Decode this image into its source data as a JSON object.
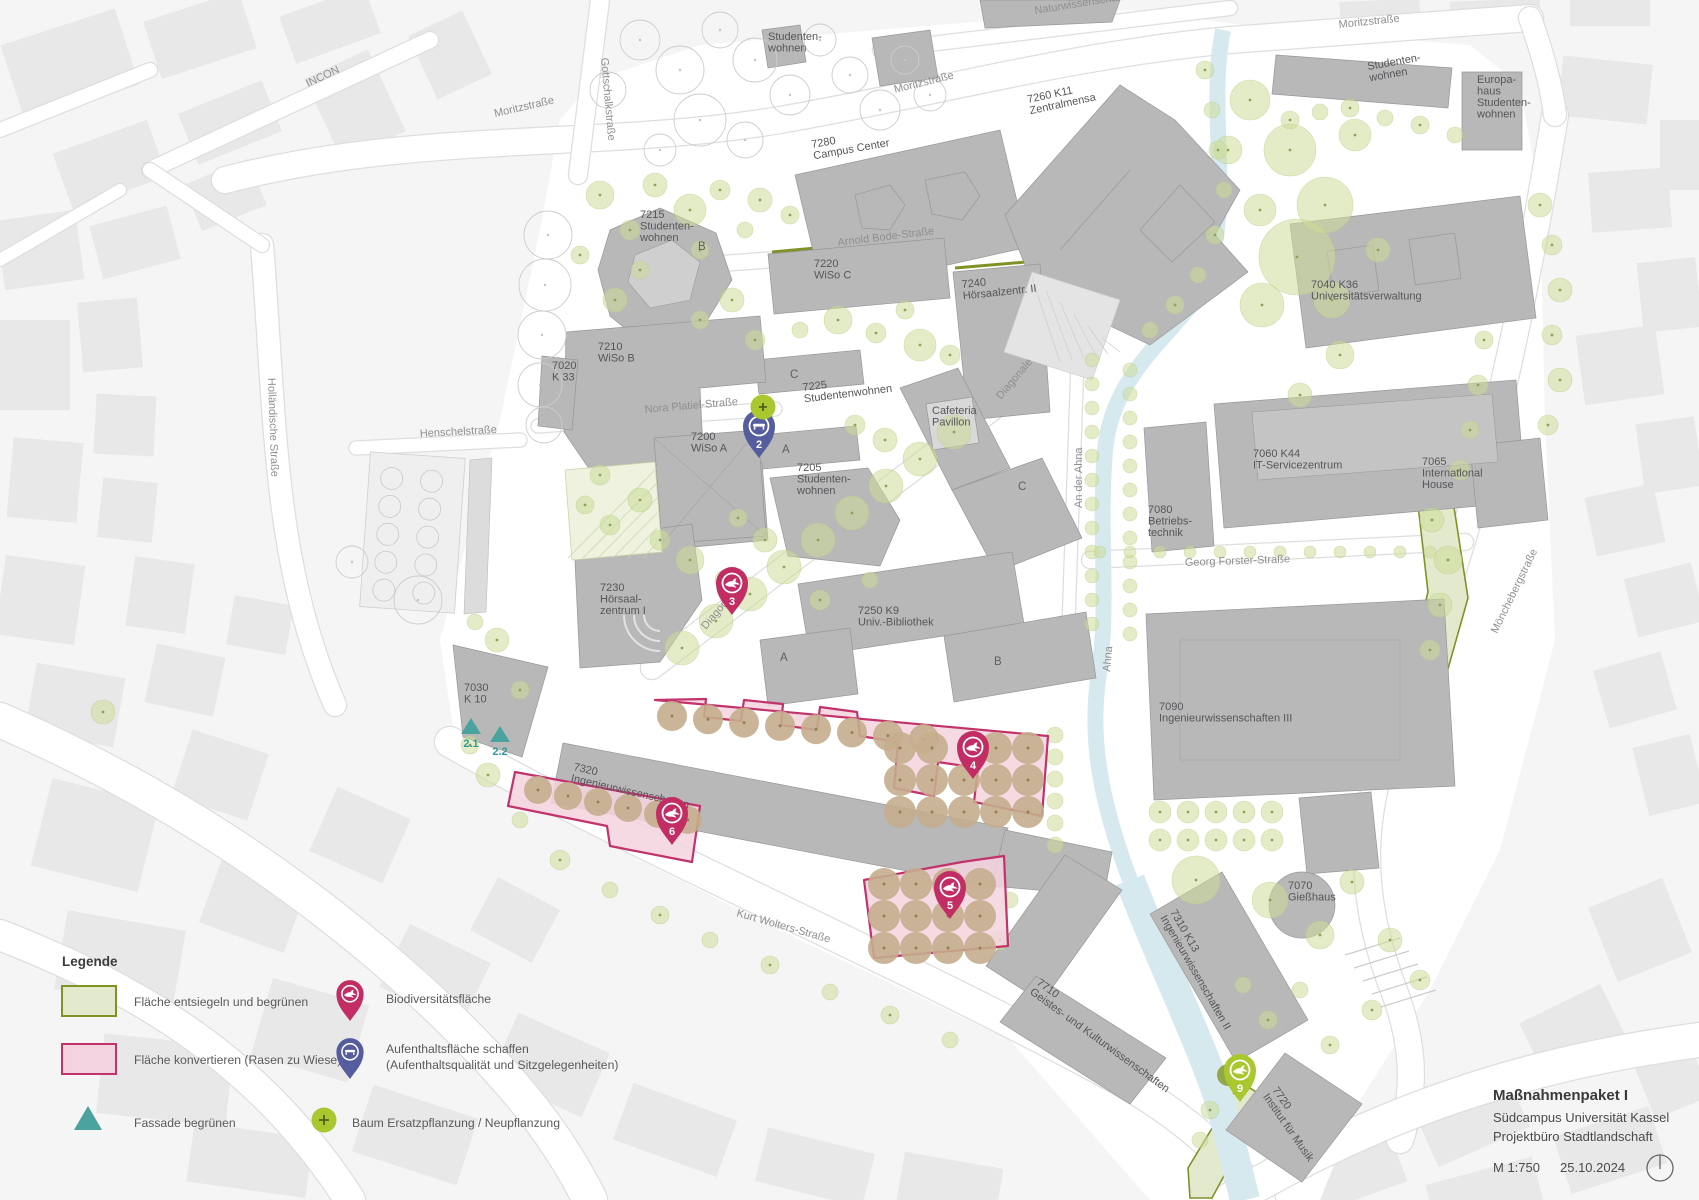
{
  "title_block": {
    "title": "Maßnahmenpaket I",
    "subtitle1": "Südcampus Universität Kassel",
    "subtitle2": "Projektbüro Stadtlandschaft",
    "scale": "M 1:750",
    "date": "25.10.2024"
  },
  "legend": {
    "heading": "Legende",
    "items": [
      {
        "swatch": "area-green",
        "label": "Fläche entsiegeln und begrünen"
      },
      {
        "swatch": "area-pink",
        "label": "Fläche konvertieren (Rasen zu Wiese)"
      },
      {
        "swatch": "pin-pink-bird",
        "label": "Biodiversitätsfläche"
      },
      {
        "swatch": "pin-blue-bench",
        "label": "Aufenthaltsfläche schaffen",
        "label2": "(Aufenthaltsqualität und Sitzgelegenheiten)"
      },
      {
        "swatch": "triangle-teal",
        "label": "Fassade begrünen"
      },
      {
        "swatch": "tree-plus",
        "label": "Baum Ersatzpflanzung / Neupflanzung"
      }
    ]
  },
  "colors": {
    "pin_pink": "#c22e63",
    "pin_blue": "#555d9e",
    "pin_green": "#a9c72f",
    "teal": "#4aa39f",
    "area_green_stroke": "#7f9226",
    "area_green_fill": "#e3e9cd",
    "area_pink_stroke": "#c2326b",
    "area_pink_fill": "#f3d3df",
    "stream": "#d6e9ef",
    "building": "#b8b8b8",
    "tree_green": "#ccdd99",
    "tree_tan": "#c5ad8d"
  },
  "map": {
    "street_labels": [
      {
        "text": "INCON",
        "x": 308,
        "y": 87,
        "rot": -25
      },
      {
        "text": "Moritzstraße",
        "x": 495,
        "y": 117,
        "rot": -13
      },
      {
        "text": "Moritzstraße",
        "x": 895,
        "y": 93,
        "rot": -14
      },
      {
        "text": "Moritzstraße",
        "x": 1339,
        "y": 28,
        "rot": -6
      },
      {
        "text": "Naturwissenschaften",
        "x": 1035,
        "y": 14,
        "rot": -9
      },
      {
        "text": "Gottschalkstraße",
        "x": 601,
        "y": 58,
        "rot": 85
      },
      {
        "text": "Holländische Straße",
        "x": 268,
        "y": 378,
        "rot": 88
      },
      {
        "text": "Henschelstraße",
        "x": 420,
        "y": 437,
        "rot": -3
      },
      {
        "text": "Arnold Bode-Straße",
        "x": 838,
        "y": 246,
        "rot": -7
      },
      {
        "text": "Nora Platiel-Straße",
        "x": 645,
        "y": 413,
        "rot": -5
      },
      {
        "text": "Diagonale",
        "x": 1001,
        "y": 400,
        "rot": -50
      },
      {
        "text": "Diagonale",
        "x": 706,
        "y": 630,
        "rot": -50
      },
      {
        "text": "Kurt Wolters-Straße",
        "x": 736,
        "y": 916,
        "rot": 16
      },
      {
        "text": "Georg Forster-Straße",
        "x": 1185,
        "y": 566,
        "rot": -2
      },
      {
        "text": "An der Ahna",
        "x": 1082,
        "y": 508,
        "rot": -90
      },
      {
        "text": "Ahna",
        "x": 1110,
        "y": 672,
        "rot": -85
      },
      {
        "text": "Mönchebergstraße",
        "x": 1497,
        "y": 634,
        "rot": -64
      }
    ],
    "building_labels": [
      {
        "lines": [
          "Studenten-",
          "wohnen"
        ],
        "x": 768,
        "y": 40
      },
      {
        "lines": [
          "7280",
          "Campus Center"
        ],
        "x": 812,
        "y": 148,
        "rot": -10
      },
      {
        "lines": [
          "7260 K11",
          "Zentralmensa"
        ],
        "x": 1028,
        "y": 103,
        "rot": -12
      },
      {
        "lines": [
          "7215",
          "Studenten-",
          "wohnen"
        ],
        "x": 640,
        "y": 218
      },
      {
        "lines": [
          "B"
        ],
        "x": 698,
        "y": 250
      },
      {
        "lines": [
          "7220",
          "WiSo C"
        ],
        "x": 814,
        "y": 267
      },
      {
        "lines": [
          "7240",
          "Hörsaalzentr. II"
        ],
        "x": 962,
        "y": 288,
        "rot": -6
      },
      {
        "lines": [
          "7210",
          "WiSo B"
        ],
        "x": 598,
        "y": 350
      },
      {
        "lines": [
          "7020",
          "K 33"
        ],
        "x": 552,
        "y": 369
      },
      {
        "lines": [
          "C"
        ],
        "x": 790,
        "y": 378
      },
      {
        "lines": [
          "7225",
          "Studentenwohnen"
        ],
        "x": 803,
        "y": 391,
        "rot": -7
      },
      {
        "lines": [
          "Cafeteria",
          "Pavillon"
        ],
        "x": 932,
        "y": 414
      },
      {
        "lines": [
          "7200",
          "WiSo A"
        ],
        "x": 691,
        "y": 440
      },
      {
        "lines": [
          "A"
        ],
        "x": 782,
        "y": 453
      },
      {
        "lines": [
          "7205",
          "Studenten-",
          "wohnen"
        ],
        "x": 797,
        "y": 471
      },
      {
        "lines": [
          "C"
        ],
        "x": 1018,
        "y": 490
      },
      {
        "lines": [
          "7080",
          "Betriebs-",
          "technik"
        ],
        "x": 1148,
        "y": 513
      },
      {
        "lines": [
          "7060 K44",
          "IT-Servicezentrum"
        ],
        "x": 1253,
        "y": 457
      },
      {
        "lines": [
          "7065",
          "International",
          "House"
        ],
        "x": 1422,
        "y": 465
      },
      {
        "lines": [
          "7040 K36",
          "Universitätsverwaltung"
        ],
        "x": 1311,
        "y": 288
      },
      {
        "lines": [
          "7230",
          "Hörsaal-",
          "zentrum I"
        ],
        "x": 600,
        "y": 591
      },
      {
        "lines": [
          "7250 K9",
          "Univ.-Bibliothek"
        ],
        "x": 858,
        "y": 614
      },
      {
        "lines": [
          "A"
        ],
        "x": 780,
        "y": 661
      },
      {
        "lines": [
          "B"
        ],
        "x": 994,
        "y": 665
      },
      {
        "lines": [
          "7030",
          "K 10"
        ],
        "x": 464,
        "y": 691
      },
      {
        "lines": [
          "7090",
          "Ingenieurwissenschaften III"
        ],
        "x": 1159,
        "y": 710
      },
      {
        "lines": [
          "7320",
          "Ingenieurwissenschaften"
        ],
        "x": 573,
        "y": 770,
        "rot": 13
      },
      {
        "lines": [
          "7310 K13",
          "Ingenieurwissenschaften II"
        ],
        "x": 1170,
        "y": 912,
        "rot": 60
      },
      {
        "lines": [
          "7710",
          "Geistes- und Kulturwissenschaften"
        ],
        "x": 1036,
        "y": 984,
        "rot": 36
      },
      {
        "lines": [
          "7070",
          "Gießhaus"
        ],
        "x": 1288,
        "y": 889
      },
      {
        "lines": [
          "7720",
          "Institut für Musik"
        ],
        "x": 1272,
        "y": 1090,
        "rot": 55
      },
      {
        "lines": [
          "Studenten-",
          "wohnen"
        ],
        "x": 1368,
        "y": 70,
        "rot": -10
      },
      {
        "lines": [
          "Europa-",
          "haus",
          "Studenten-",
          "wohnen"
        ],
        "x": 1477,
        "y": 83
      }
    ],
    "markers": [
      {
        "id": "2",
        "type": "seating",
        "x": 759,
        "y": 431
      },
      {
        "id": "3",
        "type": "biodiversity",
        "x": 732,
        "y": 588
      },
      {
        "id": "4",
        "type": "biodiversity",
        "x": 973,
        "y": 752
      },
      {
        "id": "5",
        "type": "biodiversity",
        "x": 950,
        "y": 892
      },
      {
        "id": "6",
        "type": "biodiversity",
        "x": 672,
        "y": 818
      },
      {
        "id": "9",
        "type": "greening",
        "x": 1240,
        "y": 1075
      }
    ],
    "facade_markers": [
      {
        "label": "2.1",
        "x": 471,
        "y": 727
      },
      {
        "label": "2.2",
        "x": 500,
        "y": 735
      }
    ],
    "tree_plus_markers": [
      {
        "x": 763,
        "y": 407
      }
    ]
  }
}
